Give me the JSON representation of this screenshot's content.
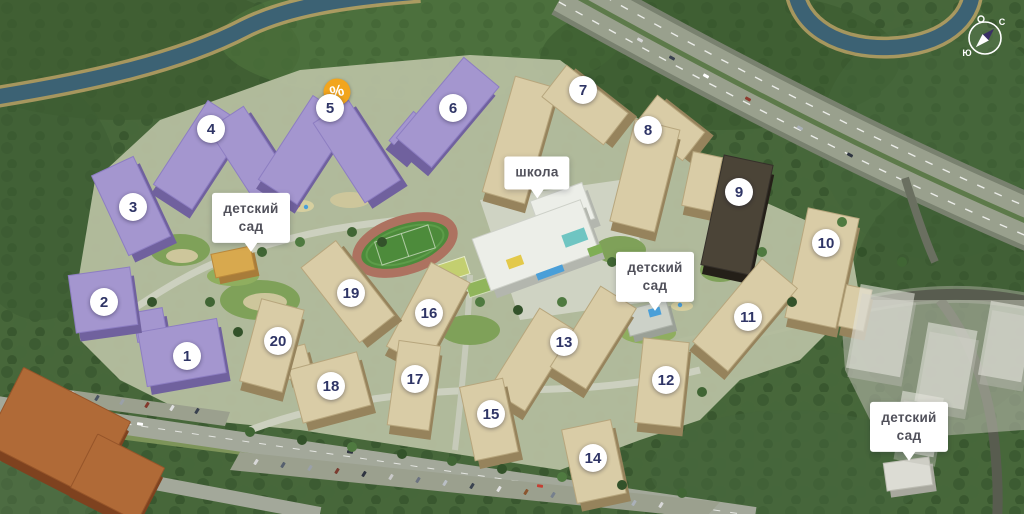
{
  "markers": [
    {
      "label": "1"
    },
    {
      "label": "2"
    },
    {
      "label": "3"
    },
    {
      "label": "4"
    },
    {
      "label": "5"
    },
    {
      "label": "6"
    },
    {
      "label": "7"
    },
    {
      "label": "8"
    },
    {
      "label": "9"
    },
    {
      "label": "10"
    },
    {
      "label": "11"
    },
    {
      "label": "12"
    },
    {
      "label": "13"
    },
    {
      "label": "14"
    },
    {
      "label": "15"
    },
    {
      "label": "16"
    },
    {
      "label": "17"
    },
    {
      "label": "18"
    },
    {
      "label": "19"
    },
    {
      "label": "20"
    }
  ],
  "promo_badge": {
    "symbol": "%"
  },
  "map_labels": {
    "school": "школа",
    "kindergarten": "детский сад"
  },
  "compass": {
    "north": "С",
    "south": "Ю"
  },
  "palette": {
    "badge_orange": "#F2A51D",
    "marker_text_navy": "#2F3566",
    "purple_buildings": "#A496CF",
    "beige_buildings": "#D9CCA6",
    "forest_green": "#47673A"
  }
}
